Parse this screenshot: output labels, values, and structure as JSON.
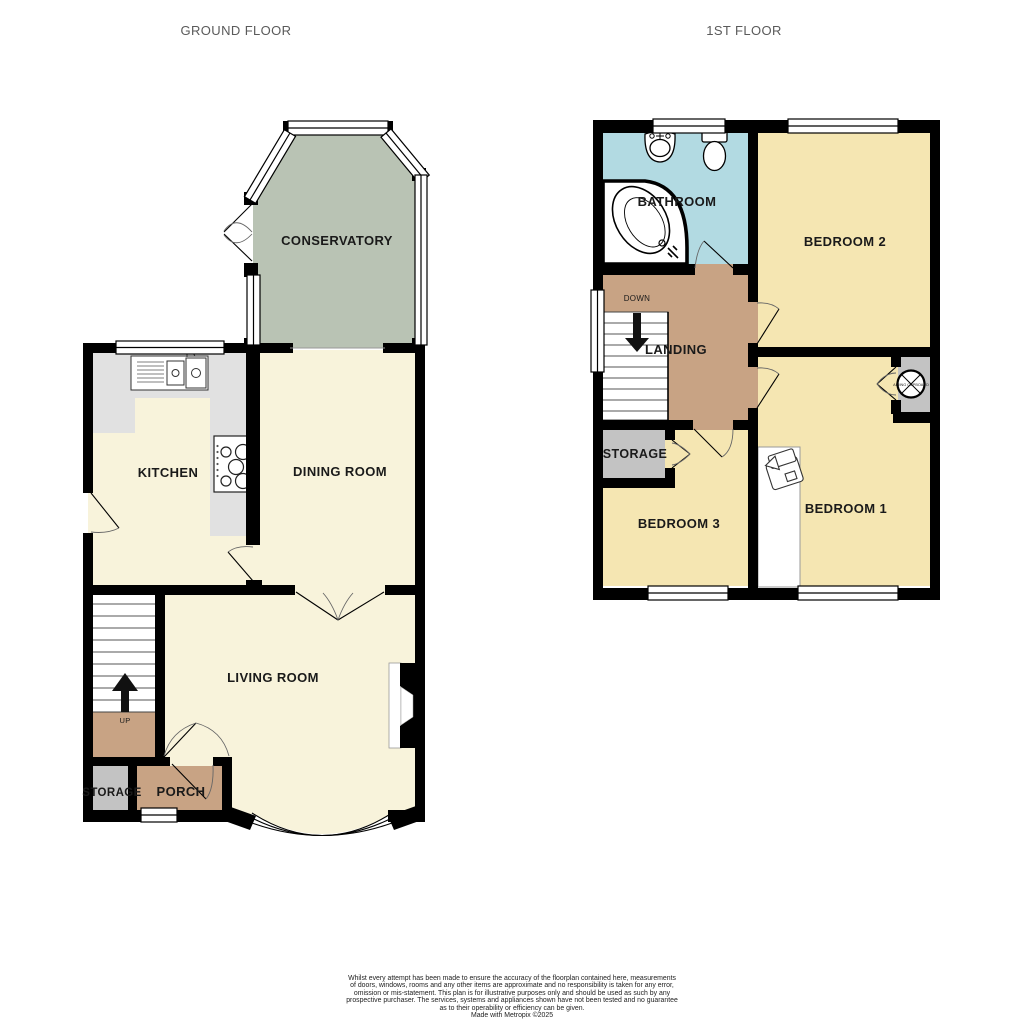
{
  "titles": {
    "ground": "GROUND FLOOR",
    "first": "1ST FLOOR"
  },
  "ground_floor": {
    "conservatory": "CONSERVATORY",
    "kitchen": "KITCHEN",
    "dining_room": "DINING ROOM",
    "living_room": "LIVING ROOM",
    "porch": "PORCH",
    "storage": "STORAGE",
    "up": "UP"
  },
  "first_floor": {
    "bathroom": "BATHROOM",
    "bedroom2": "BEDROOM 2",
    "landing": "LANDING",
    "down": "DOWN",
    "storage": "STORAGE",
    "bedroom3": "BEDROOM 3",
    "bedroom1": "BEDROOM 1",
    "airing_cupboard": "AIRING CUPBOARD"
  },
  "colors": {
    "wall": "#000000",
    "cream": "#F8F3DB",
    "yellow": "#F5E6B2",
    "tan": "#C8A384",
    "sage": "#B9C3B4",
    "blue": "#B2DAE2",
    "room_gray": "#C3C3C3",
    "counter_gray": "#E1E1E1",
    "stair_white": "#FFFFFF",
    "label": "#1a1a1a",
    "title": "#5a5a5a"
  },
  "footer": {
    "lines": [
      "Whilst every attempt has been made to ensure the accuracy of the floorplan contained here, measurements",
      "of doors, windows, rooms and any other items are approximate and no responsibility is taken for any error,",
      "omission or mis-statement. This plan is for illustrative purposes only and should be used as such by any",
      "prospective purchaser. The services, systems and appliances shown have not been tested and no guarantee",
      "as to their operability or efficiency can be given."
    ],
    "credit": "Made with Metropix ©2025"
  }
}
